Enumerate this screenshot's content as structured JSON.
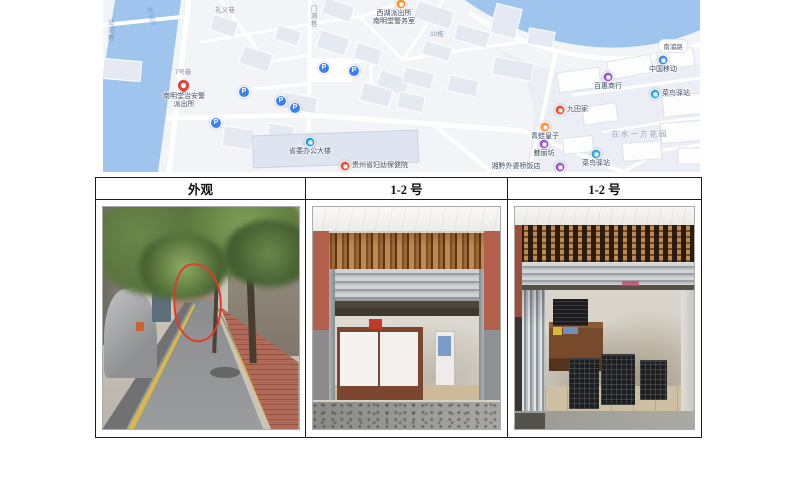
{
  "document": {
    "type": "场地照片资料页",
    "table": {
      "headers": [
        "外观",
        "1-2 号",
        "1-2 号"
      ]
    },
    "photos": [
      {
        "caption": "外观",
        "description": "小巷街景：两侧绿树成荫，左侧停放盖着灰色车衣的汽车，右侧灰墙、青色雨棚与红砖人行道，道路黄色标线，红色手绘圈标注店面位置"
      },
      {
        "caption": "1-2 号",
        "description": "商铺内景：卷帘门半开，上方木条格栅带，两侧红褐色立柱，店内白色柜台带深色木边框，米色瓷砖地面"
      },
      {
        "caption": "1-2 号",
        "description": "商铺内景：卷帘门全开，左侧折叠推拉门，店内木桌上及地面摆放黑色塑料筐，墙面有污渍"
      }
    ]
  },
  "map": {
    "colors": {
      "water": "#9FC5EF",
      "land": "#F2F4F8",
      "road": "#FFFFFF",
      "building": "#E4E9F2",
      "building_white": "#FDFDFE",
      "parking_blue": "#3D7FF7",
      "pin_red": "#E2413C"
    },
    "area_label": "在水一方花园",
    "road_labels": [
      {
        "text": "南浦路",
        "x": 570,
        "y": 46,
        "style": "pill"
      },
      {
        "text": "礼义巷",
        "x": 122,
        "y": 9,
        "style": "plain"
      },
      {
        "text": "门洞巷",
        "x": 209,
        "y": 16,
        "style": "vertical"
      },
      {
        "text": "10栋",
        "x": 334,
        "y": 33,
        "style": "plain"
      },
      {
        "text": "7号巷",
        "x": 80,
        "y": 71,
        "style": "plain"
      },
      {
        "text": "南明河",
        "x": 49,
        "y": 16,
        "style": "water"
      },
      {
        "text": "沿河巷",
        "x": 6,
        "y": 30,
        "style": "vertical"
      },
      {
        "text": "在水一方花园",
        "x": 537,
        "y": 134,
        "style": "area"
      }
    ],
    "markers": [
      {
        "type": "parking",
        "x": 221,
        "y": 68,
        "label": ""
      },
      {
        "type": "parking",
        "x": 251,
        "y": 71,
        "label": ""
      },
      {
        "type": "parking",
        "x": 141,
        "y": 92,
        "label": ""
      },
      {
        "type": "parking",
        "x": 178,
        "y": 101,
        "label": ""
      },
      {
        "type": "parking",
        "x": 192,
        "y": 108,
        "label": ""
      },
      {
        "type": "parking",
        "x": 113,
        "y": 123,
        "label": ""
      },
      {
        "type": "pin",
        "color": "#E2413C",
        "x": 81,
        "y": 86,
        "label": "南明堂治安警\n派出所",
        "lx": 81,
        "ly": 93,
        "pos": "below",
        "name": "police-station-pin"
      },
      {
        "type": "dot",
        "color": "#F5932F",
        "x": 298,
        "y": 4,
        "label": "西湖派出所\n南明堂警务室",
        "lx": 291,
        "ly": 10,
        "pos": "below",
        "name": "police-post-poi"
      },
      {
        "type": "dot",
        "color": "#2F9FE5",
        "x": 207,
        "y": 142,
        "label": "省委办公大楼",
        "lx": 207,
        "ly": 148,
        "pos": "below",
        "name": "government-building-poi"
      },
      {
        "type": "dot",
        "color": "#E8503A",
        "x": 242,
        "y": 166,
        "label": "贵州省妇幼保健院",
        "lx": 249,
        "ly": 166,
        "pos": "right",
        "name": "hospital-poi"
      },
      {
        "type": "dot",
        "color": "#3A8FF0",
        "x": 560,
        "y": 60,
        "label": "中国移动",
        "lx": 560,
        "ly": 66,
        "pos": "below",
        "name": "china-mobile-poi"
      },
      {
        "type": "dot",
        "color": "#2FA8E8",
        "x": 552,
        "y": 94,
        "label": "菜鸟驿站",
        "lx": 559,
        "ly": 94,
        "pos": "right",
        "name": "cainiao-station-poi"
      },
      {
        "type": "dot",
        "color": "#9B59D0",
        "x": 505,
        "y": 77,
        "label": "百惠商行",
        "lx": 505,
        "ly": 83,
        "pos": "below",
        "name": "shop-poi"
      },
      {
        "type": "dot",
        "color": "#E8503A",
        "x": 457,
        "y": 110,
        "label": "九田家",
        "lx": 464,
        "ly": 110,
        "pos": "right",
        "name": "restaurant-poi"
      },
      {
        "type": "dot",
        "color": "#F5932F",
        "x": 442,
        "y": 127,
        "label": "青蛙皇子",
        "lx": 442,
        "ly": 133,
        "pos": "below",
        "name": "kids-shop-poi"
      },
      {
        "type": "dot",
        "color": "#9B59D0",
        "x": 441,
        "y": 144,
        "label": "魅丽坊",
        "lx": 441,
        "ly": 150,
        "pos": "below",
        "name": "beauty-shop-poi"
      },
      {
        "type": "dot",
        "color": "#2FA8E8",
        "x": 493,
        "y": 154,
        "label": "菜鸟驿站",
        "lx": 493,
        "ly": 160,
        "pos": "below",
        "name": "cainiao-station-poi-2"
      },
      {
        "type": "dot",
        "color": "#9B59D0",
        "x": 457,
        "y": 167,
        "label": "湘黔外婆桥饭店",
        "lx": 413,
        "ly": 163,
        "pos": "center",
        "name": "restaurant-poi-2"
      }
    ]
  }
}
